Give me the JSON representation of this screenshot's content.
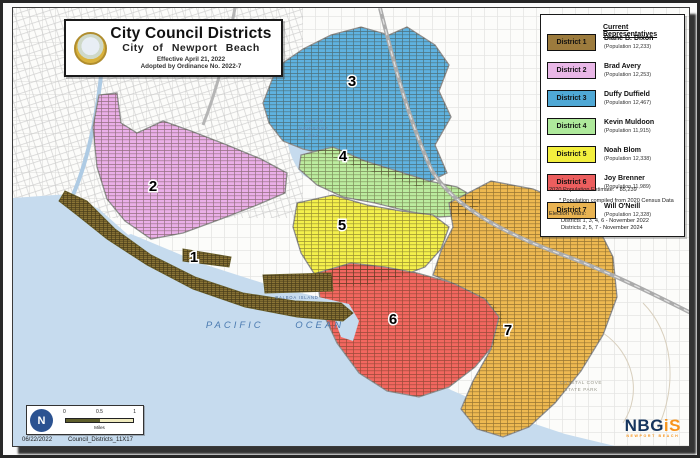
{
  "title_box": {
    "title": "City Council Districts",
    "subtitle": "City of Newport Beach",
    "effective": "Effective April 21, 2022",
    "adopted": "Adopted by Ordinance No. 2022-7"
  },
  "legend": {
    "header": "Current Representatives",
    "districts": [
      {
        "label": "District 1",
        "color": "#9c7b3d",
        "map_color": "#8b7536",
        "rep": "Diane B. Dixon",
        "population": "(Population 12,233)"
      },
      {
        "label": "District 2",
        "color": "#e9b7e7",
        "map_color": "#eaafe8",
        "rep": "Brad Avery",
        "population": "(Population 12,253)"
      },
      {
        "label": "District 3",
        "color": "#4fa8d5",
        "map_color": "#5fb2e0",
        "rep": "Duffy Duffield",
        "population": "(Population 12,467)"
      },
      {
        "label": "District 4",
        "color": "#aee99b",
        "map_color": "#bcec9f",
        "rep": "Kevin Muldoon",
        "population": "(Population 11,915)"
      },
      {
        "label": "District 5",
        "color": "#f3ef3e",
        "map_color": "#f4f04c",
        "rep": "Noah Blom",
        "population": "(Population 12,338)"
      },
      {
        "label": "District 6",
        "color": "#ec5e5e",
        "map_color": "#f2675f",
        "rep": "Joy Brenner",
        "population": "(Population 11,989)"
      },
      {
        "label": "District 7",
        "color": "#e9b351",
        "map_color": "#eeb951",
        "rep": "Will O'Neill",
        "population": "(Population 12,328)"
      }
    ],
    "pop_note": "2020 Population Estimate: * 85,239",
    "census_note": "* Population compiled from 2020 Census Data",
    "election_header": "Election Years:",
    "election_1": "Districts 1, 3, 4, 6 - November 2022",
    "election_2": "Districts 2, 5, 7 - November 2024"
  },
  "map": {
    "ocean_label": "PACIFIC OCEAN",
    "bay_line1": "UPPER",
    "bay_line2": "NEWPORT",
    "bay_line3": "BAY",
    "island_label": "BALBOA ISLAND",
    "park_line1": "CRYSTAL COVE",
    "park_line2": "STATE PARK",
    "numbers": [
      "1",
      "2",
      "3",
      "4",
      "5",
      "6",
      "7"
    ]
  },
  "scalebar": {
    "t0": "0",
    "t05": "0.5",
    "t1": "1",
    "unit": "Miles"
  },
  "footer": {
    "date": "06/22/2022",
    "filename": "Council_Districts_11X17"
  },
  "logo": {
    "nb": "NB",
    "g": "G",
    "i": "i",
    "s": "S",
    "subtext": "NEWPORT BEACH"
  },
  "colors": {
    "ocean": "#c6dbee",
    "water_label": "#4a7ab0",
    "frame": "#262626"
  }
}
